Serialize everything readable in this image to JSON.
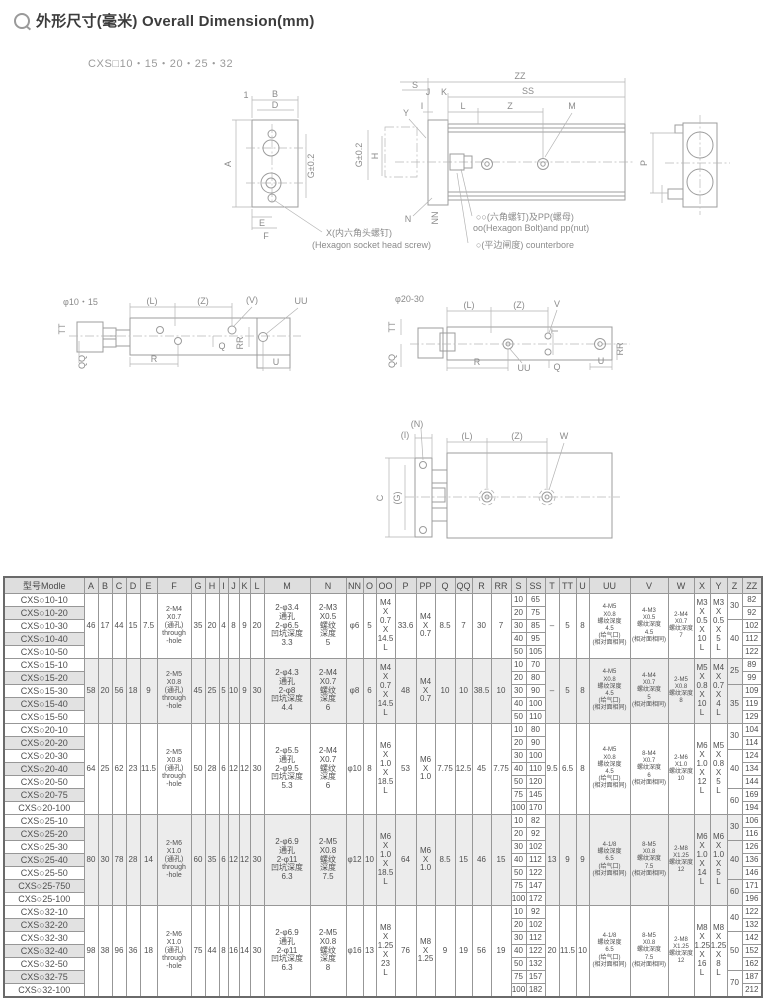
{
  "page": {
    "title": "外形尺寸(毫米) Overall Dimension(mm)",
    "subtitle": "CXS□10・15・20・25・32"
  },
  "diagrams": {
    "plate": {
      "b": "B",
      "d": "D",
      "one": "1",
      "a": "A",
      "g": "G±0.2",
      "e": "E",
      "f": "F",
      "callout1": "X(内六角头螺钉)",
      "callout2": "(Hexagon socket head screw)"
    },
    "side": {
      "s": "S",
      "zz": "ZZ",
      "ss": "SS",
      "j": "J",
      "k": "K",
      "y": "Y",
      "i": "I",
      "l": "L",
      "z": "Z",
      "m": "M",
      "g": "G±0.2",
      "h": "H",
      "n": "N",
      "nn": "NN",
      "callout1": "○○(六角螺钉)及PP(螺母)",
      "callout2": "oo(Hexagon Bolt)and pp(nut)",
      "callout3": "○(平边闸度) counterbore"
    },
    "end": {
      "p": "P"
    },
    "view1015": {
      "title": "φ10・15",
      "l": "(L)",
      "z": "(Z)",
      "v": "(V)",
      "uu": "UU",
      "tt": "TT",
      "qq": "QQ",
      "q": "Q",
      "rr": "RR",
      "r": "R",
      "u": "U"
    },
    "view2030": {
      "title": "φ20-30",
      "l": "(L)",
      "z": "(Z)",
      "v": "V",
      "uu": "UU",
      "tt": "TT",
      "qq": "QQ",
      "q": "Q",
      "rr": "RR",
      "r": "R",
      "u": "U",
      "t": "T"
    },
    "bottom": {
      "n": "(N)",
      "i": "(I)",
      "l": "(L)",
      "z": "(Z)",
      "w": "W",
      "c": "C",
      "g": "(G)"
    }
  },
  "table": {
    "headers": [
      "型号Modle",
      "A",
      "B",
      "C",
      "D",
      "E",
      "F",
      "G",
      "H",
      "I",
      "J",
      "K",
      "L",
      "M",
      "N",
      "NN",
      "O",
      "OO",
      "P",
      "PP",
      "Q",
      "QQ",
      "R",
      "RR",
      "S",
      "SS",
      "T",
      "TT",
      "U",
      "UU",
      "V",
      "W",
      "X",
      "Y",
      "Z",
      "ZZ"
    ],
    "col_widths": [
      80,
      14,
      14,
      14,
      14,
      17,
      34,
      14,
      14,
      9,
      11,
      11,
      14,
      46,
      36,
      17,
      13,
      19,
      21,
      19,
      20,
      17,
      19,
      20,
      15,
      19,
      14,
      17,
      13,
      41,
      38,
      26,
      16,
      17,
      15,
      20
    ],
    "groups": [
      {
        "shaded": false,
        "models": [
          "CXS○10-10",
          "CXS○10-20",
          "CXS○10-30",
          "CXS○10-40",
          "CXS○10-50"
        ],
        "s": [
          "10",
          "20",
          "30",
          "40",
          "50"
        ],
        "ss": [
          "65",
          "75",
          "85",
          "95",
          "105"
        ],
        "zz": [
          "82",
          "92",
          "102",
          "112",
          "122"
        ],
        "z": [
          {
            "v": "30",
            "rows": 2
          },
          {
            "v": "40",
            "rows": 3
          }
        ],
        "merged": {
          "A": "46",
          "B": "17",
          "C": "44",
          "D": "15",
          "E": "7.5",
          "F": "2-M4\nX0.7\n(通孔)\nthrough\n-hole",
          "G": "35",
          "H": "20",
          "I": "4",
          "J": "8",
          "K": "9",
          "L": "20",
          "M": "2-φ3.4\n通孔\n2-φ6.5\n凹坑深度\n3.3",
          "N": "2-M3\nX0.5\n螺纹\n深度\n5",
          "NN": "φ6",
          "O": "5",
          "OO": "M4\nX\n0.7\nX\n14.5\nL",
          "P": "33.6",
          "PP": "M4\nX\n0.7",
          "Q": "8.5",
          "QQ": "7",
          "R": "30",
          "RR": "7",
          "T": "–",
          "TT": "5",
          "U": "8",
          "UU": "4-M5\nX0.8\n螺纹深度\n4.5\n(给气口)\n(相对面相同)",
          "V": "4-M3\nX0.5\n螺纹深度\n4.5\n(相对面相同)",
          "W": "2-M4\nX0.7\n螺纹深度\n7",
          "X": "M3\nX\n0.5\nX\n10\nL",
          "Y": "M3\nX\n0.5\nX\n5\nL"
        }
      },
      {
        "shaded": true,
        "models": [
          "CXS○15-10",
          "CXS○15-20",
          "CXS○15-30",
          "CXS○15-40",
          "CXS○15-50"
        ],
        "s": [
          "10",
          "20",
          "30",
          "40",
          "50"
        ],
        "ss": [
          "70",
          "80",
          "90",
          "100",
          "110"
        ],
        "zz": [
          "89",
          "99",
          "109",
          "119",
          "129"
        ],
        "z": [
          {
            "v": "25",
            "rows": 2
          },
          {
            "v": "35",
            "rows": 3
          }
        ],
        "merged": {
          "A": "58",
          "B": "20",
          "C": "56",
          "D": "18",
          "E": "9",
          "F": "2-M5\nX0.8\n(通孔)\nthrough\n-hole",
          "G": "45",
          "H": "25",
          "I": "5",
          "J": "10",
          "K": "9",
          "L": "30",
          "M": "2-φ4.3\n通孔\n2-φ8\n凹坑深度\n4.4",
          "N": "2-M4\nX0.7\n螺纹\n深度\n6",
          "NN": "φ8",
          "O": "6",
          "OO": "M4\nX\n0.7\nX\n14.5\nL",
          "P": "48",
          "PP": "M4\nX\n0.7",
          "Q": "10",
          "QQ": "10",
          "R": "38.5",
          "RR": "10",
          "T": "–",
          "TT": "5",
          "U": "8",
          "UU": "4-M5\nX0.8\n螺纹深度\n4.5\n(给气口)\n(相对面相同)",
          "V": "4-M4\nX0.7\n螺纹深度\n5\n(相对面相同)",
          "W": "2-M5\nX0.8\n螺纹深度\n8",
          "X": "M5\nX\n0.8\nX\n10\nL",
          "Y": "M4\nX\n0.7\nX\n4\nL"
        }
      },
      {
        "shaded": false,
        "models": [
          "CXS○20-10",
          "CXS○20-20",
          "CXS○20-30",
          "CXS○20-40",
          "CXS○20-50",
          "CXS○20-75",
          "CXS○20-100"
        ],
        "s": [
          "10",
          "20",
          "30",
          "40",
          "50",
          "75",
          "100"
        ],
        "ss": [
          "80",
          "90",
          "100",
          "110",
          "120",
          "145",
          "170"
        ],
        "zz": [
          "104",
          "114",
          "124",
          "134",
          "144",
          "169",
          "194"
        ],
        "z": [
          {
            "v": "30",
            "rows": 2
          },
          {
            "v": "40",
            "rows": 3
          },
          {
            "v": "60",
            "rows": 2
          }
        ],
        "merged": {
          "A": "64",
          "B": "25",
          "C": "62",
          "D": "23",
          "E": "11.5",
          "F": "2-M5\nX0.8\n(通孔)\nthrough\n-hole",
          "G": "50",
          "H": "28",
          "I": "6",
          "J": "12",
          "K": "12",
          "L": "30",
          "M": "2-φ5.5\n通孔\n2-φ9.5\n凹坑深度\n5.3",
          "N": "2-M4\nX0.7\n螺纹\n深度\n6",
          "NN": "φ10",
          "O": "8",
          "OO": "M6\nX\n1.0\nX\n18.5\nL",
          "P": "53",
          "PP": "M6\nX\n1.0",
          "Q": "7.75",
          "QQ": "12.5",
          "R": "45",
          "RR": "7.75",
          "T": "9.5",
          "TT": "6.5",
          "U": "8",
          "UU": "4-M5\nX0.8\n螺纹深度\n4.5\n(给气口)\n(相对面相同)",
          "V": "8-M4\nX0.7\n螺纹深度\n6\n(相对面相同)",
          "W": "2-M6\nX1.0\n螺纹深度\n10",
          "X": "M6\nX\n1.0\nX\n12\nL",
          "Y": "M5\nX\n0.8\nX\n5\nL"
        }
      },
      {
        "shaded": true,
        "models": [
          "CXS○25-10",
          "CXS○25-20",
          "CXS○25-30",
          "CXS○25-40",
          "CXS○25-50",
          "CXS○25-750",
          "CXS○25-100"
        ],
        "s": [
          "10",
          "20",
          "30",
          "40",
          "50",
          "75",
          "100"
        ],
        "ss": [
          "82",
          "92",
          "102",
          "112",
          "122",
          "147",
          "172"
        ],
        "zz": [
          "106",
          "116",
          "126",
          "136",
          "146",
          "171",
          "196"
        ],
        "z": [
          {
            "v": "30",
            "rows": 2
          },
          {
            "v": "40",
            "rows": 3
          },
          {
            "v": "60",
            "rows": 2
          }
        ],
        "merged": {
          "A": "80",
          "B": "30",
          "C": "78",
          "D": "28",
          "E": "14",
          "F": "2-M6\nX1.0\n(通孔)\nthrough\n-hole",
          "G": "60",
          "H": "35",
          "I": "6",
          "J": "12",
          "K": "12",
          "L": "30",
          "M": "2-φ6.9\n通孔\n2-φ11\n凹坑深度\n6.3",
          "N": "2-M5\nX0.8\n螺纹\n深度\n7.5",
          "NN": "φ12",
          "O": "10",
          "OO": "M6\nX\n1.0\nX\n18.5\nL",
          "P": "64",
          "PP": "M6\nX\n1.0",
          "Q": "8.5",
          "QQ": "15",
          "R": "46",
          "RR": "15",
          "T": "13",
          "TT": "9",
          "U": "9",
          "UU": "4-1/8\n螺纹深度\n6.5\n(给气口)\n(相对面相同)",
          "V": "8-M5\nX0.8\n螺纹深度\n7.5\n(相对面相同)",
          "W": "2-M8\nX1.25\n螺纹深度\n12",
          "X": "M6\nX\n1.0\nX\n14\nL",
          "Y": "M6\nX\n1.0\nX\n5\nL"
        }
      },
      {
        "shaded": false,
        "models": [
          "CXS○32-10",
          "CXS○32-20",
          "CXS○32-30",
          "CXS○32-40",
          "CXS○32-50",
          "CXS○32-75",
          "CXS○32-100"
        ],
        "s": [
          "10",
          "20",
          "30",
          "40",
          "50",
          "75",
          "100"
        ],
        "ss": [
          "92",
          "102",
          "112",
          "122",
          "132",
          "157",
          "182"
        ],
        "zz": [
          "122",
          "132",
          "142",
          "152",
          "162",
          "187",
          "212"
        ],
        "z": [
          {
            "v": "40",
            "rows": 2
          },
          {
            "v": "50",
            "rows": 3
          },
          {
            "v": "70",
            "rows": 2
          }
        ],
        "merged": {
          "A": "98",
          "B": "38",
          "C": "96",
          "D": "36",
          "E": "18",
          "F": "2-M6\nX1.0\n(通孔)\nthrough\n-hole",
          "G": "75",
          "H": "44",
          "I": "8",
          "J": "16",
          "K": "14",
          "L": "30",
          "M": "2-φ6.9\n通孔\n2-φ11\n凹坑深度\n6.3",
          "N": "2-M5\nX0.8\n螺纹\n深度\n8",
          "NN": "φ16",
          "O": "13",
          "OO": "M8\nX\n1.25\nX\n23\nL",
          "P": "76",
          "PP": "M8\nX\n1.25",
          "Q": "9",
          "QQ": "19",
          "R": "56",
          "RR": "19",
          "T": "20",
          "TT": "11.5",
          "U": "10",
          "UU": "4-1/8\n螺纹深度\n6.5\n(给气口)\n(相对面相同)",
          "V": "8-M5\nX0.8\n螺纹深度\n7.5\n(相对面相同)",
          "W": "2-M8\nX1.25\n螺纹深度\n12",
          "X": "M8\nX\n1.25\nX\n16\nL",
          "Y": "M8\nX\n1.25\nX\n8\nL"
        }
      }
    ]
  }
}
